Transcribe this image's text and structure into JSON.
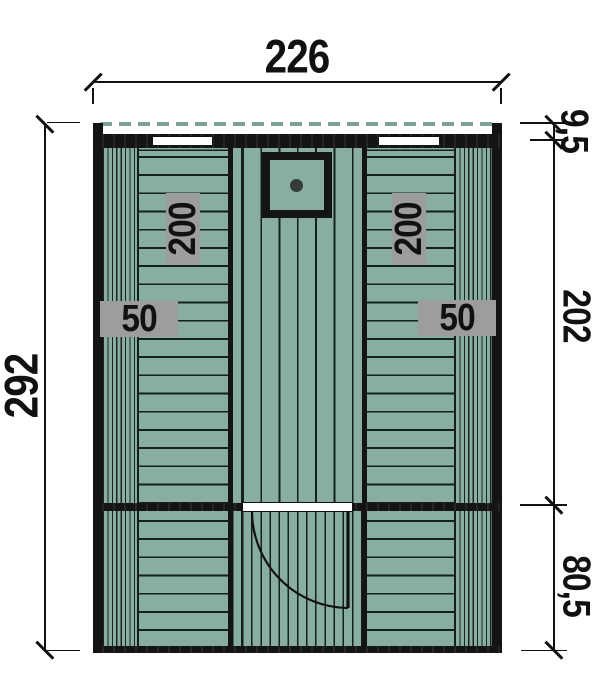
{
  "drawing": {
    "kind": "floor-plan",
    "dimensions": {
      "overall_width": "226",
      "overall_height": "292",
      "roof_overhang": "9,5",
      "main_room_depth": "202",
      "front_room_depth": "80,5"
    },
    "bench_labels": {
      "left_length": "200",
      "left_depth": "50",
      "right_length": "200",
      "right_depth": "50"
    },
    "colors": {
      "floor": "#87aea0",
      "outline": "#141414",
      "label_background": "#9d9da0",
      "roof_dash_line": "#7da294",
      "text": "#111111"
    }
  }
}
